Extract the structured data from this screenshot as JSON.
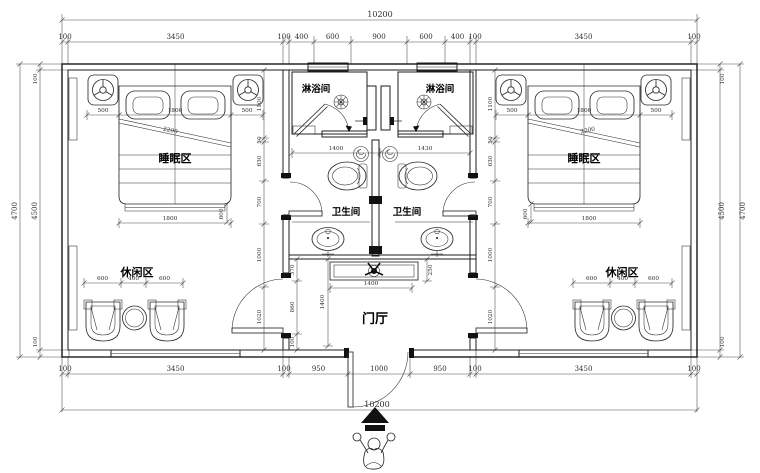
{
  "plan": {
    "type": "hotel-guest-room-floor-plan",
    "rooms": {
      "sleep": "睡眠区",
      "leisure": "休闲区",
      "shower": "淋浴间",
      "wc": "卫生间",
      "foyer": "门厅"
    },
    "dims": {
      "overall": "10200",
      "top": [
        "100",
        "3450",
        "100",
        "400",
        "600",
        "900",
        "600",
        "400",
        "100",
        "3450",
        "100"
      ],
      "bottom": [
        "100",
        "3450",
        "100",
        "950",
        "1000",
        "950",
        "100",
        "3450",
        "100"
      ],
      "side": {
        "outer": "4700",
        "inner": "4500",
        "wall": "100"
      },
      "bed": {
        "head": [
          "500",
          "1800",
          "500"
        ],
        "foot": "1800",
        "foot_side": "600",
        "diag": "2200"
      },
      "room_chain": [
        "1100",
        "50",
        "630",
        "700",
        "1000",
        "1020"
      ],
      "leisure": [
        "600",
        "400",
        "600"
      ],
      "wc": {
        "left": "1400",
        "right": "1430"
      },
      "foyer": {
        "console_w": "1400",
        "console_d": "250",
        "chain": [
          "370",
          "860",
          "100"
        ],
        "depth": "1400"
      }
    },
    "icons": {
      "ceiling_light": "ceiling-light-symbol",
      "floor_drain": "floor-drain-symbol",
      "spiral_drain": "spiral-drain-symbol",
      "fan": "ceiling-fan-symbol",
      "entry_arrow": "entry-direction-arrow",
      "person": "person-entering-figure"
    }
  }
}
